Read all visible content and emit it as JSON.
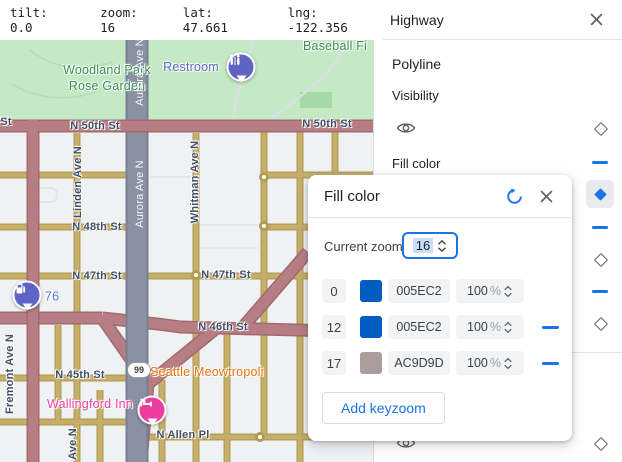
{
  "topbar": {
    "items": [
      "tilt: 0.0",
      "zoom: 16",
      "lat: 47.661",
      "lng: -122.356"
    ]
  },
  "panel": {
    "title": "Highway",
    "section_label": "Polyline",
    "visibility_label": "Visibility",
    "fill_color_label": "Fill color"
  },
  "dialog": {
    "title": "Fill color",
    "current_zoom_label": "Current zoom",
    "current_zoom_value": "16",
    "add_keyzoom_label": "Add keyzoom",
    "rows": [
      {
        "zoom": "0",
        "swatch": "#005EC2",
        "hex": "005EC2",
        "opacity": "100",
        "unit": "%",
        "removable": false
      },
      {
        "zoom": "12",
        "swatch": "#005EC2",
        "hex": "005EC2",
        "opacity": "100",
        "unit": "%",
        "removable": true
      },
      {
        "zoom": "17",
        "swatch": "#AC9D9D",
        "hex": "AC9D9D",
        "opacity": "100",
        "unit": "%",
        "removable": true
      }
    ]
  },
  "map": {
    "shield": "99",
    "labels": [
      {
        "text": "Woodland Park Rose Garden",
        "kind": "park"
      },
      {
        "text": "Baseball Fi",
        "kind": "park"
      },
      {
        "text": "Restroom",
        "kind": "poi"
      },
      {
        "text": "St",
        "kind": "street"
      },
      {
        "text": "N 50th St",
        "kind": "street"
      },
      {
        "text": "N 50th St",
        "kind": "street"
      },
      {
        "text": "N 48th St",
        "kind": "street"
      },
      {
        "text": "N 47th St",
        "kind": "street"
      },
      {
        "text": "N 47th St",
        "kind": "street"
      },
      {
        "text": "N 46th St",
        "kind": "street"
      },
      {
        "text": "N 45th St",
        "kind": "street"
      },
      {
        "text": "N Allen Pl",
        "kind": "street"
      },
      {
        "text": "Seattle Meowtropoli",
        "kind": "poi"
      },
      {
        "text": "Wallingford Inn",
        "kind": "poi"
      },
      {
        "text": "76",
        "kind": "poi"
      },
      {
        "text": "Fremont Ave N",
        "kind": "street"
      },
      {
        "text": "Linden Ave N",
        "kind": "street"
      },
      {
        "text": "Aurora Ave N",
        "kind": "street"
      },
      {
        "text": "Aurora Ave N",
        "kind": "street"
      },
      {
        "text": "Whitman Ave N",
        "kind": "street"
      },
      {
        "text": "Ave N",
        "kind": "street"
      }
    ]
  },
  "icons": {
    "close": "x-cross",
    "reset": "circular-arrow",
    "eye": "visibility-eye",
    "diamond": "keyzoom-diamond",
    "dash": "value-set-dash",
    "stepper": "up-down-chevrons",
    "restroom-pin": "restroom-glyph",
    "gas-pin": "fuel-pump-glyph",
    "hotel-pin": "bed-glyph"
  },
  "colors": {
    "accent-blue": "#1a73e8",
    "selection-blue": "#c9ddfc",
    "swatch-blue": "#005EC2",
    "swatch-mauve": "#AC9D9D",
    "road-highway": "#8a91a3",
    "road-arterial": "#b67e82",
    "road-local": "#c5af6b",
    "park-green": "#c5e8c5"
  }
}
